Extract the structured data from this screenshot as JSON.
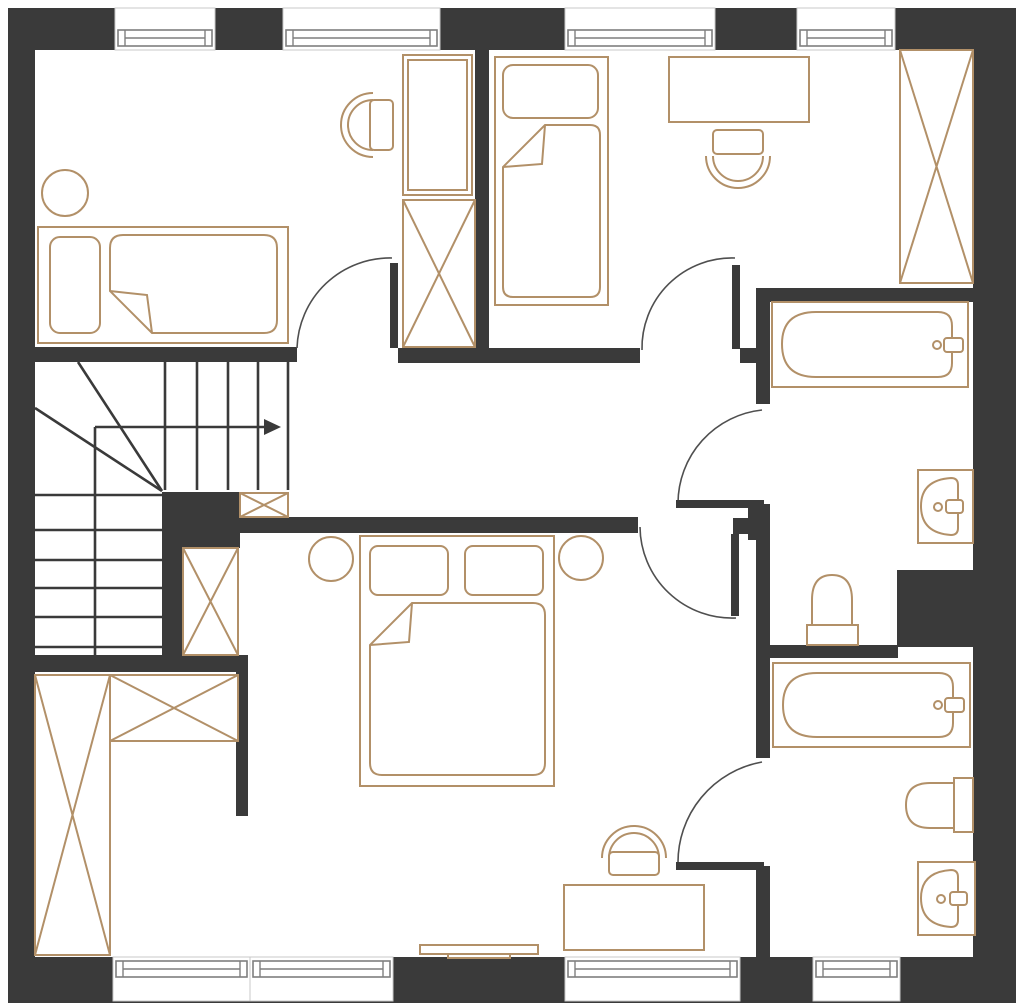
{
  "meta": {
    "type": "floor-plan",
    "title": ""
  },
  "canvas": {
    "width": 1024,
    "height": 1007,
    "background": "#ffffff"
  },
  "palette": {
    "wall": "#3a3a3a",
    "furniture_outline": "#b29068",
    "stair_line": "#3a3a3a",
    "door_arc": "#4f4f4f",
    "window_frame": "#7f7f7f",
    "floor": "#ffffff"
  },
  "walls": [
    {
      "id": "wall-outer-top",
      "x": 8,
      "y": 8,
      "w": 1008,
      "h": 42
    },
    {
      "id": "wall-outer-left",
      "x": 8,
      "y": 8,
      "w": 27,
      "h": 995
    },
    {
      "id": "wall-outer-right",
      "x": 973,
      "y": 8,
      "w": 43,
      "h": 995
    },
    {
      "id": "wall-outer-bottom",
      "x": 8,
      "y": 957,
      "w": 1008,
      "h": 46
    },
    {
      "id": "wall-bedroom1-south-west",
      "x": 35,
      "y": 347,
      "w": 262,
      "h": 15
    },
    {
      "id": "wall-bedroom1-south-east",
      "x": 398,
      "y": 348,
      "w": 242,
      "h": 15
    },
    {
      "id": "wall-bedroom1-bedroom2-divider",
      "x": 475,
      "y": 50,
      "w": 14,
      "h": 300
    },
    {
      "id": "wall-hall-stub-east",
      "x": 740,
      "y": 348,
      "w": 16,
      "h": 15
    },
    {
      "id": "wall-bath1-north",
      "x": 756,
      "y": 288,
      "w": 217,
      "h": 14
    },
    {
      "id": "wall-bath1-west-upper",
      "x": 756,
      "y": 288,
      "w": 14,
      "h": 116
    },
    {
      "id": "wall-bath1-west-mid",
      "x": 756,
      "y": 504,
      "w": 14,
      "h": 254
    },
    {
      "id": "wall-bath2-west-lower",
      "x": 756,
      "y": 866,
      "w": 14,
      "h": 92
    },
    {
      "id": "wall-hall-corner-a",
      "x": 733,
      "y": 518,
      "w": 25,
      "h": 16
    },
    {
      "id": "wall-hall-corner-b",
      "x": 748,
      "y": 504,
      "w": 22,
      "h": 36
    },
    {
      "id": "wall-bath-divider",
      "x": 768,
      "y": 645,
      "w": 130,
      "h": 13
    },
    {
      "id": "wall-duct-block",
      "x": 897,
      "y": 570,
      "w": 76,
      "h": 77
    },
    {
      "id": "wall-stair-core",
      "x": 162,
      "y": 492,
      "w": 78,
      "h": 56
    },
    {
      "id": "wall-master-north",
      "x": 238,
      "y": 517,
      "w": 400,
      "h": 16
    },
    {
      "id": "wall-stair-east",
      "x": 162,
      "y": 492,
      "w": 21,
      "h": 180
    },
    {
      "id": "wall-stair-south",
      "x": 35,
      "y": 655,
      "w": 213,
      "h": 17
    },
    {
      "id": "wall-closet-east",
      "x": 236,
      "y": 672,
      "w": 12,
      "h": 144
    }
  ],
  "windows": [
    {
      "id": "window-top-1",
      "x": 115,
      "y": 8,
      "w": 100,
      "h": 42,
      "sash_y": 30,
      "sash_h": 16
    },
    {
      "id": "window-top-2",
      "x": 283,
      "y": 8,
      "w": 157,
      "h": 42,
      "sash_y": 30,
      "sash_h": 16
    },
    {
      "id": "window-top-3",
      "x": 565,
      "y": 8,
      "w": 150,
      "h": 42,
      "sash_y": 30,
      "sash_h": 16
    },
    {
      "id": "window-top-4",
      "x": 797,
      "y": 8,
      "w": 98,
      "h": 42,
      "sash_y": 30,
      "sash_h": 16
    },
    {
      "id": "window-bottom-1",
      "x": 113,
      "y": 957,
      "w": 137,
      "h": 44,
      "sash_y": 961,
      "sash_h": 16
    },
    {
      "id": "window-bottom-2",
      "x": 250,
      "y": 957,
      "w": 143,
      "h": 44,
      "sash_y": 961,
      "sash_h": 16
    },
    {
      "id": "window-bottom-3",
      "x": 565,
      "y": 957,
      "w": 175,
      "h": 44,
      "sash_y": 961,
      "sash_h": 16
    },
    {
      "id": "window-bottom-4",
      "x": 813,
      "y": 957,
      "w": 87,
      "h": 44,
      "sash_y": 961,
      "sash_h": 16
    }
  ],
  "doors": [
    {
      "id": "door-bedroom-1",
      "leaf": {
        "x": 390,
        "y": 263,
        "w": 8,
        "h": 85
      },
      "arc": "M297,348 A93,93 0 0 1 392,258"
    },
    {
      "id": "door-bedroom-2",
      "leaf": {
        "x": 732,
        "y": 265,
        "w": 8,
        "h": 84
      },
      "arc": "M642,350 A90,90 0 0 1 735,258"
    },
    {
      "id": "door-master-bedroom",
      "leaf": {
        "x": 731,
        "y": 534,
        "w": 8,
        "h": 82
      },
      "arc": "M640,527 A92,92 0 0 0 736,618"
    },
    {
      "id": "door-bathroom-1",
      "leaf": {
        "x": 676,
        "y": 500,
        "w": 88,
        "h": 8
      },
      "arc": "M762,410 A94,94 0 0 0 678,503"
    },
    {
      "id": "door-bathroom-2",
      "leaf": {
        "x": 676,
        "y": 862,
        "w": 88,
        "h": 8
      },
      "arc": "M762,762 A102,102 0 0 0 678,864"
    }
  ],
  "stairs": {
    "lines": [
      [
        165,
        362,
        165,
        490
      ],
      [
        197,
        362,
        197,
        490
      ],
      [
        228,
        362,
        228,
        490
      ],
      [
        258,
        362,
        258,
        490
      ],
      [
        288,
        362,
        288,
        490
      ],
      [
        35,
        495,
        163,
        495
      ],
      [
        35,
        530,
        163,
        530
      ],
      [
        35,
        560,
        163,
        560
      ],
      [
        35,
        588,
        163,
        588
      ],
      [
        35,
        617,
        163,
        617
      ],
      [
        35,
        647,
        163,
        647
      ],
      [
        95,
        427,
        95,
        655
      ],
      [
        78,
        362,
        162,
        491
      ],
      [
        35,
        408,
        162,
        491
      ]
    ],
    "arrow_line": [
      95,
      427,
      266,
      427
    ],
    "arrow_head": "281,427 264,419 264,435"
  },
  "furniture": [
    {
      "id": "single-bed-1",
      "shapes": [
        {
          "k": "rect",
          "x": 38,
          "y": 227,
          "w": 250,
          "h": 116,
          "cls": "tanfill"
        },
        {
          "k": "rect",
          "x": 50,
          "y": 237,
          "w": 50,
          "h": 96,
          "rx": 10,
          "cls": "tanfill"
        },
        {
          "k": "path",
          "d": "M123,235 H264 Q277,235 277,248 V320 Q277,333 264,333 H152 L110,291 V248 Q110,235 123,235 Z",
          "cls": "tanfill"
        },
        {
          "k": "path",
          "d": "M152,333 L147,295 L110,291",
          "cls": "tan"
        }
      ]
    },
    {
      "id": "side-table-round-1",
      "shapes": [
        {
          "k": "circle",
          "cx": 65,
          "cy": 193,
          "r": 23,
          "cls": "tanfill"
        }
      ]
    },
    {
      "id": "desk-chair-1",
      "shapes": [
        {
          "k": "path",
          "d": "M373,93 A32,32 0 0 0 373,157",
          "cls": "tan"
        },
        {
          "k": "path",
          "d": "M373,100 A25,25 0 0 0 373,150",
          "cls": "tan"
        },
        {
          "k": "rect",
          "x": 370,
          "y": 100,
          "w": 23,
          "h": 50,
          "rx": 4,
          "cls": "tanfill"
        }
      ]
    },
    {
      "id": "tall-cabinet-1",
      "shapes": [
        {
          "k": "rect",
          "x": 403,
          "y": 55,
          "w": 69,
          "h": 140,
          "cls": "tanfill"
        },
        {
          "k": "rect",
          "x": 408,
          "y": 60,
          "w": 59,
          "h": 130,
          "cls": "tan"
        }
      ]
    },
    {
      "id": "wardrobe-x-1",
      "shapes": [
        {
          "k": "rect",
          "x": 403,
          "y": 200,
          "w": 72,
          "h": 147,
          "cls": "tanfill"
        },
        {
          "k": "line",
          "x1": 403,
          "y1": 200,
          "x2": 475,
          "y2": 347,
          "cls": "tan"
        },
        {
          "k": "line",
          "x1": 475,
          "y1": 200,
          "x2": 403,
          "y2": 347,
          "cls": "tan"
        }
      ]
    },
    {
      "id": "single-bed-2",
      "shapes": [
        {
          "k": "rect",
          "x": 495,
          "y": 57,
          "w": 113,
          "h": 248,
          "cls": "tanfill"
        },
        {
          "k": "rect",
          "x": 503,
          "y": 65,
          "w": 95,
          "h": 53,
          "rx": 10,
          "cls": "tanfill"
        },
        {
          "k": "path",
          "d": "M545,125 H590 Q600,125 600,135 V287 Q600,297 590,297 H513 Q503,297 503,287 V167 Z",
          "cls": "tanfill"
        },
        {
          "k": "path",
          "d": "M545,125 L542,164 L503,167",
          "cls": "tan"
        }
      ]
    },
    {
      "id": "desk-2",
      "shapes": [
        {
          "k": "rect",
          "x": 669,
          "y": 57,
          "w": 140,
          "h": 65,
          "cls": "tanfill"
        }
      ]
    },
    {
      "id": "desk-chair-2",
      "shapes": [
        {
          "k": "path",
          "d": "M706,156 A32,32 0 0 0 770,156",
          "cls": "tan"
        },
        {
          "k": "path",
          "d": "M713,156 A25,25 0 0 0 763,156",
          "cls": "tan"
        },
        {
          "k": "rect",
          "x": 713,
          "y": 130,
          "w": 50,
          "h": 24,
          "rx": 4,
          "cls": "tanfill"
        }
      ]
    },
    {
      "id": "wardrobe-x-2",
      "shapes": [
        {
          "k": "rect",
          "x": 900,
          "y": 50,
          "w": 73,
          "h": 233,
          "cls": "tanfill"
        },
        {
          "k": "line",
          "x1": 900,
          "y1": 50,
          "x2": 973,
          "y2": 283,
          "cls": "tan"
        },
        {
          "k": "line",
          "x1": 973,
          "y1": 50,
          "x2": 900,
          "y2": 283,
          "cls": "tan"
        }
      ]
    },
    {
      "id": "bathtub-1",
      "shapes": [
        {
          "k": "rect",
          "x": 772,
          "y": 302,
          "w": 196,
          "h": 85,
          "cls": "tanfill"
        },
        {
          "k": "path",
          "d": "M816,312 H938 Q952,312 952,326 V363 Q952,377 938,377 H816 Q782,377 782,344 Q782,312 816,312 Z",
          "cls": "tan"
        },
        {
          "k": "circle",
          "cx": 937,
          "cy": 345,
          "r": 4,
          "cls": "tan"
        },
        {
          "k": "rect",
          "x": 944,
          "y": 338,
          "w": 19,
          "h": 14,
          "rx": 3,
          "cls": "tanfill"
        }
      ]
    },
    {
      "id": "sink-1",
      "shapes": [
        {
          "k": "rect",
          "x": 918,
          "y": 470,
          "w": 55,
          "h": 73,
          "cls": "tanfill"
        },
        {
          "k": "path",
          "d": "M951,478 Q921,480 921,506 Q921,533 951,535 Q958,535 958,528 V485 Q958,478 951,478 Z",
          "cls": "tan"
        },
        {
          "k": "circle",
          "cx": 938,
          "cy": 507,
          "r": 4,
          "cls": "tan"
        },
        {
          "k": "rect",
          "x": 946,
          "y": 500,
          "w": 17,
          "h": 13,
          "rx": 3,
          "cls": "tanfill"
        }
      ]
    },
    {
      "id": "toilet-1",
      "shapes": [
        {
          "k": "path",
          "d": "M812,630 V600 Q812,575 832,575 Q852,575 852,600 V630",
          "cls": "tan"
        },
        {
          "k": "rect",
          "x": 807,
          "y": 625,
          "w": 51,
          "h": 20,
          "cls": "tanfill"
        }
      ]
    },
    {
      "id": "bathtub-2",
      "shapes": [
        {
          "k": "rect",
          "x": 773,
          "y": 663,
          "w": 197,
          "h": 84,
          "cls": "tanfill"
        },
        {
          "k": "path",
          "d": "M817,673 H939 Q953,673 953,687 V723 Q953,737 939,737 H817 Q783,737 783,705 Q783,673 817,673 Z",
          "cls": "tan"
        },
        {
          "k": "circle",
          "cx": 938,
          "cy": 705,
          "r": 4,
          "cls": "tan"
        },
        {
          "k": "rect",
          "x": 945,
          "y": 698,
          "w": 19,
          "h": 14,
          "rx": 3,
          "cls": "tanfill"
        }
      ]
    },
    {
      "id": "toilet-2",
      "shapes": [
        {
          "k": "path",
          "d": "M956,783 H930 Q906,783 906,805 Q906,828 930,828 H956",
          "cls": "tan"
        },
        {
          "k": "rect",
          "x": 954,
          "y": 778,
          "w": 19,
          "h": 54,
          "cls": "tanfill"
        }
      ]
    },
    {
      "id": "sink-2",
      "shapes": [
        {
          "k": "rect",
          "x": 918,
          "y": 862,
          "w": 57,
          "h": 73,
          "cls": "tanfill"
        },
        {
          "k": "path",
          "d": "M951,870 Q921,872 921,898 Q921,925 951,927 Q958,927 958,920 V877 Q958,870 951,870 Z",
          "cls": "tan"
        },
        {
          "k": "circle",
          "cx": 941,
          "cy": 899,
          "r": 4,
          "cls": "tan"
        },
        {
          "k": "rect",
          "x": 950,
          "y": 892,
          "w": 17,
          "h": 13,
          "rx": 3,
          "cls": "tanfill"
        }
      ]
    },
    {
      "id": "double-bed",
      "shapes": [
        {
          "k": "rect",
          "x": 360,
          "y": 536,
          "w": 194,
          "h": 250,
          "cls": "tanfill"
        },
        {
          "k": "rect",
          "x": 370,
          "y": 546,
          "w": 78,
          "h": 49,
          "rx": 8,
          "cls": "tanfill"
        },
        {
          "k": "rect",
          "x": 465,
          "y": 546,
          "w": 78,
          "h": 49,
          "rx": 8,
          "cls": "tanfill"
        },
        {
          "k": "path",
          "d": "M412,603 H533 Q545,603 545,615 V763 Q545,775 533,775 H382 Q370,775 370,763 V645 Z",
          "cls": "tanfill"
        },
        {
          "k": "path",
          "d": "M412,603 L409,642 L370,645",
          "cls": "tan"
        }
      ]
    },
    {
      "id": "nightstand-round-left",
      "shapes": [
        {
          "k": "circle",
          "cx": 331,
          "cy": 559,
          "r": 22,
          "cls": "tanfill"
        }
      ]
    },
    {
      "id": "nightstand-round-right",
      "shapes": [
        {
          "k": "circle",
          "cx": 581,
          "cy": 558,
          "r": 22,
          "cls": "tanfill"
        }
      ]
    },
    {
      "id": "desk-3",
      "shapes": [
        {
          "k": "rect",
          "x": 564,
          "y": 885,
          "w": 140,
          "h": 65,
          "cls": "tanfill"
        }
      ]
    },
    {
      "id": "desk-chair-3",
      "shapes": [
        {
          "k": "path",
          "d": "M602,858 A32,32 0 0 1 666,858",
          "cls": "tan"
        },
        {
          "k": "path",
          "d": "M609,858 A25,25 0 0 1 659,858",
          "cls": "tan"
        },
        {
          "k": "rect",
          "x": 609,
          "y": 852,
          "w": 50,
          "h": 23,
          "rx": 4,
          "cls": "tanfill"
        }
      ]
    },
    {
      "id": "tv-console",
      "shapes": [
        {
          "k": "rect",
          "x": 420,
          "y": 945,
          "w": 118,
          "h": 9,
          "cls": "tanfill"
        },
        {
          "k": "rect",
          "x": 448,
          "y": 954,
          "w": 62,
          "h": 4,
          "cls": "tanfill"
        }
      ]
    },
    {
      "id": "closet-wardrobe-x-vertical",
      "shapes": [
        {
          "k": "rect",
          "x": 35,
          "y": 675,
          "w": 75,
          "h": 280,
          "cls": "tanfill"
        },
        {
          "k": "line",
          "x1": 35,
          "y1": 675,
          "x2": 110,
          "y2": 955,
          "cls": "tan"
        },
        {
          "k": "line",
          "x1": 110,
          "y1": 675,
          "x2": 35,
          "y2": 955,
          "cls": "tan"
        }
      ]
    },
    {
      "id": "closet-wardrobe-x-horizontal",
      "shapes": [
        {
          "k": "rect",
          "x": 110,
          "y": 675,
          "w": 128,
          "h": 66,
          "cls": "tanfill"
        },
        {
          "k": "line",
          "x1": 110,
          "y1": 675,
          "x2": 238,
          "y2": 741,
          "cls": "tan"
        },
        {
          "k": "line",
          "x1": 238,
          "y1": 675,
          "x2": 110,
          "y2": 741,
          "cls": "tan"
        }
      ]
    },
    {
      "id": "hall-cabinet-x-small",
      "shapes": [
        {
          "k": "rect",
          "x": 240,
          "y": 493,
          "w": 48,
          "h": 24,
          "cls": "tanfill"
        },
        {
          "k": "line",
          "x1": 240,
          "y1": 493,
          "x2": 288,
          "y2": 517,
          "cls": "tan"
        },
        {
          "k": "line",
          "x1": 288,
          "y1": 493,
          "x2": 240,
          "y2": 517,
          "cls": "tan"
        }
      ]
    },
    {
      "id": "niche-cabinet-x",
      "shapes": [
        {
          "k": "rect",
          "x": 183,
          "y": 548,
          "w": 55,
          "h": 107,
          "cls": "tanfill"
        },
        {
          "k": "line",
          "x1": 183,
          "y1": 548,
          "x2": 238,
          "y2": 655,
          "cls": "tan"
        },
        {
          "k": "line",
          "x1": 238,
          "y1": 548,
          "x2": 183,
          "y2": 655,
          "cls": "tan"
        }
      ]
    }
  ]
}
